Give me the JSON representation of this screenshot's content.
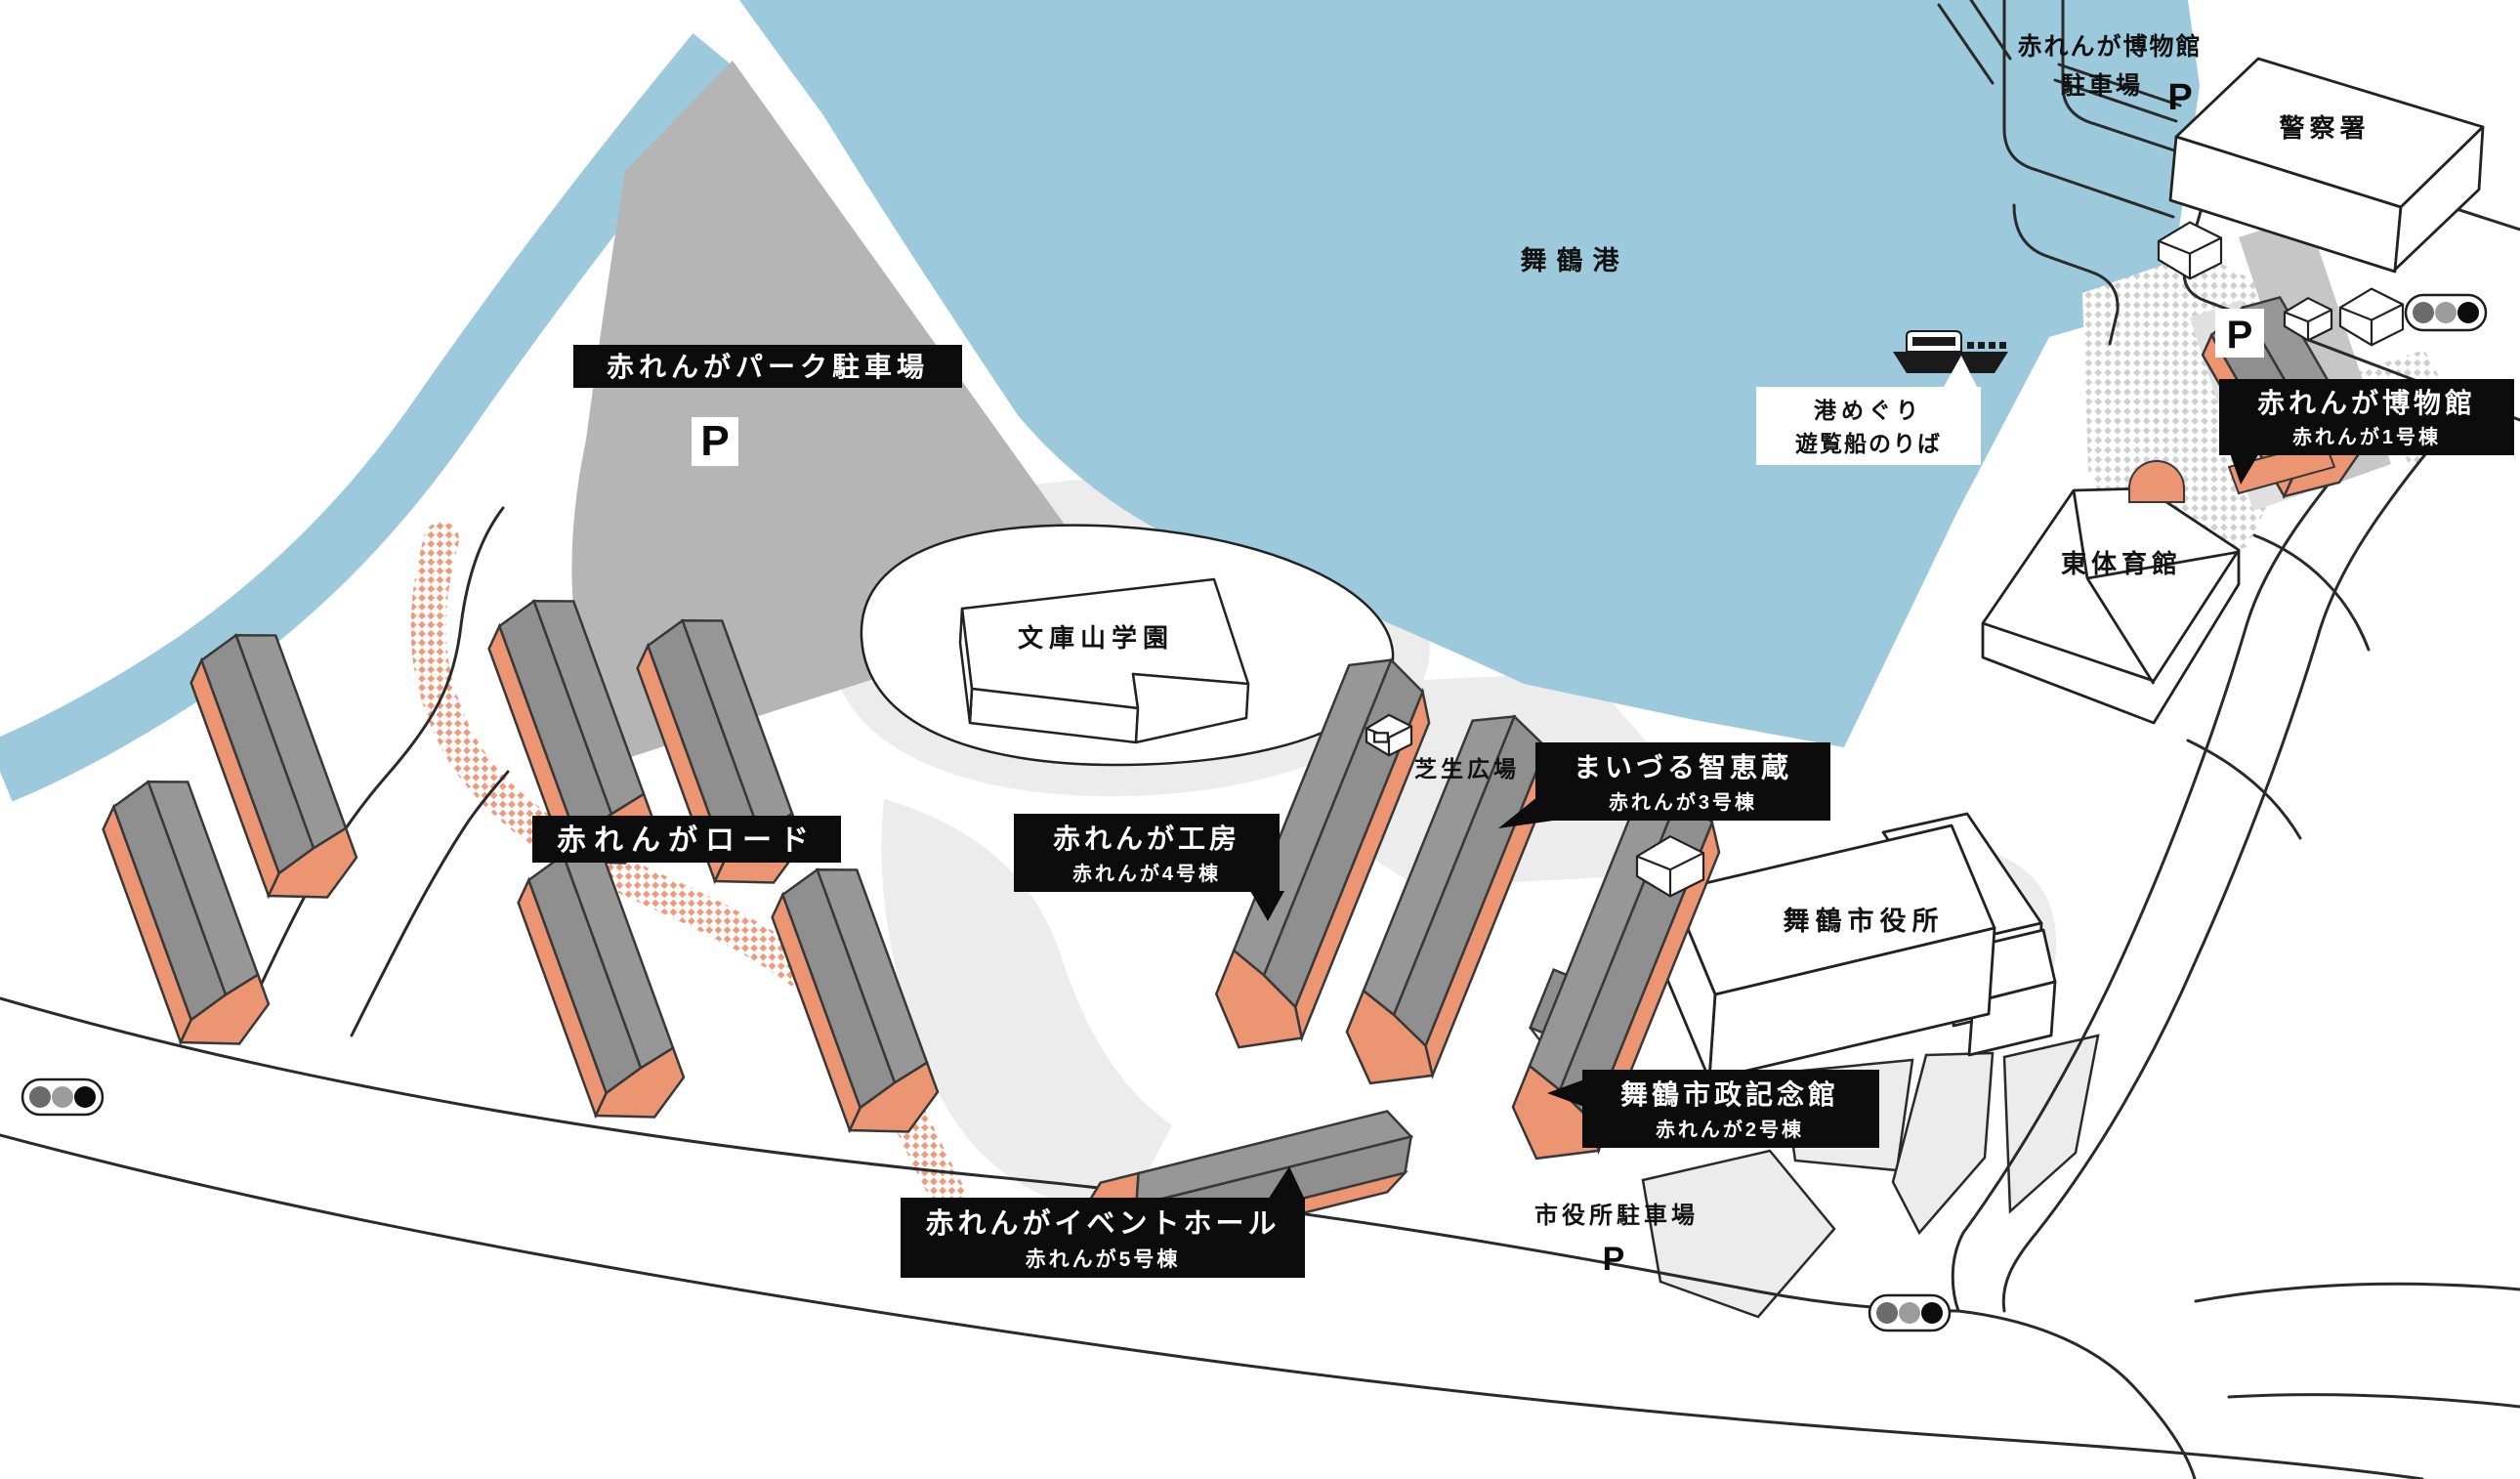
{
  "map_title": "Maizuru Red Brick Park area illustrated map",
  "labels": {
    "harbor": "舞鶴港",
    "museum_parking_line1": "赤れんが博物館",
    "museum_parking_line2": "駐車場",
    "police": "警察署",
    "cruise_line1": "港めぐり",
    "cruise_line2": "遊覧船のりば",
    "museum_title": "赤れんが博物館",
    "museum_sub": "赤れんが1号棟",
    "gym": "東体育館",
    "park_parking": "赤れんがパーク駐車場",
    "bunkozan": "文庫山学園",
    "lawn": "芝生広場",
    "chiekura_title": "まいづる智恵蔵",
    "chiekura_sub": "赤れんが3号棟",
    "kobo_title": "赤れんが工房",
    "kobo_sub": "赤れんが4号棟",
    "brick_road": "赤れんがロード",
    "city_hall": "舞鶴市役所",
    "kinenkan_title": "舞鶴市政記念館",
    "kinenkan_sub": "赤れんが2号棟",
    "event_title": "赤れんがイベントホール",
    "event_sub": "赤れんが5号棟",
    "city_hall_parking": "市役所駐車場",
    "parking_symbol": "P"
  },
  "colors": {
    "water": "#9DC9DC",
    "parking_lot": "#B5B5B5",
    "ground_light": "#ECECEC",
    "warehouse_wall": "#EB9572",
    "warehouse_roof": "#8F8F8F",
    "brick_road_dots": "#F09A7C",
    "label_bg": "#0C0C0C",
    "label_text": "#FFFFFF",
    "outline": "#2A2A2A"
  },
  "icons": {
    "traffic_light_count": 3,
    "boat": "sightseeing-boat",
    "parking_markers": 4
  }
}
